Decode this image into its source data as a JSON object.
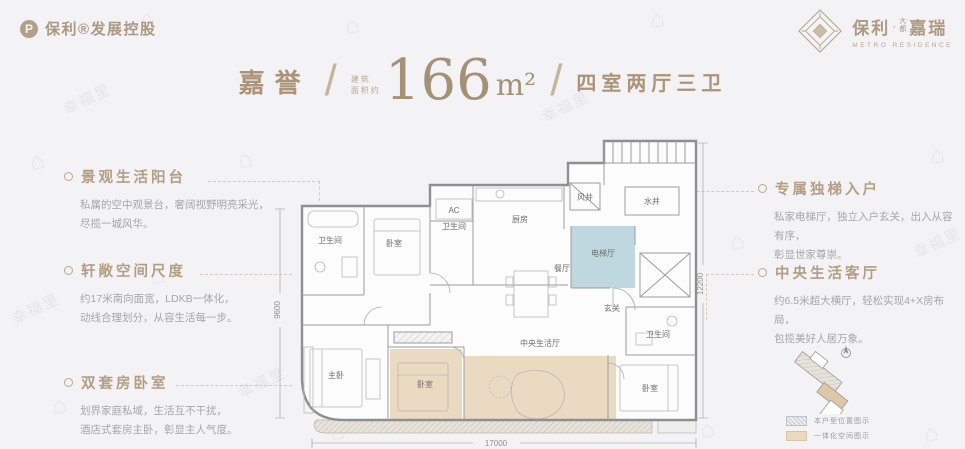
{
  "watermark": {
    "text": "幸福里",
    "icon": "⌂"
  },
  "brand_left": {
    "logo_letter": "P",
    "text": "保利®发展控股"
  },
  "brand_right": {
    "name_main": "保利",
    "dot": "·",
    "name_small": "大\n都",
    "name_sub": "嘉瑞",
    "tagline": "METRO RESIDENCE"
  },
  "header": {
    "project": "嘉誉",
    "slash": "/",
    "area_prefix": "建筑\n面积约",
    "area_value": "166",
    "area_unit": "m²",
    "layout": "四室两厅三卫"
  },
  "features_left": [
    {
      "title": "景观生活阳台",
      "body": "私属的空中观景台，奢阔视野明亮采光，\n尽揽一城风华。"
    },
    {
      "title": "轩敞空间尺度",
      "body": "约17米南向面宽，LDKB一体化，\n动线合理划分，从容生活每一步。"
    },
    {
      "title": "双套房卧室",
      "body": "划界家庭私域，生活互不干扰，\n酒店式套房主卧，彰显主人气度。"
    }
  ],
  "features_right": [
    {
      "title": "专属独梯入户",
      "body": "私家电梯厅，独立入户玄关，出入从容有序，\n彰显世家尊崇。"
    },
    {
      "title": "中央生活客厅",
      "body": "约6.5米超大横厅，轻松实现4+X房布局，\n包揽美好人居万象。"
    }
  ],
  "floorplan": {
    "rooms": {
      "bath1": "卫生间",
      "bed_top": "卧室",
      "ac": "AC",
      "bath2": "卫生间",
      "kitchen": "厨房",
      "wind_shaft": "风井",
      "water_shaft": "水井",
      "elevator_hall": "电梯厅",
      "dining": "餐厅",
      "foyer": "玄关",
      "bath3": "卫生间",
      "master": "主卧",
      "bed_mid": "卧室",
      "central_living": "中央生活厅",
      "bed_right": "卧室"
    },
    "dims": {
      "bottom": "17000",
      "left": "9600",
      "right": "12200"
    }
  },
  "legend": {
    "items": [
      {
        "label": "本户型位置图示"
      },
      {
        "label": "一体化空间图示"
      }
    ]
  }
}
